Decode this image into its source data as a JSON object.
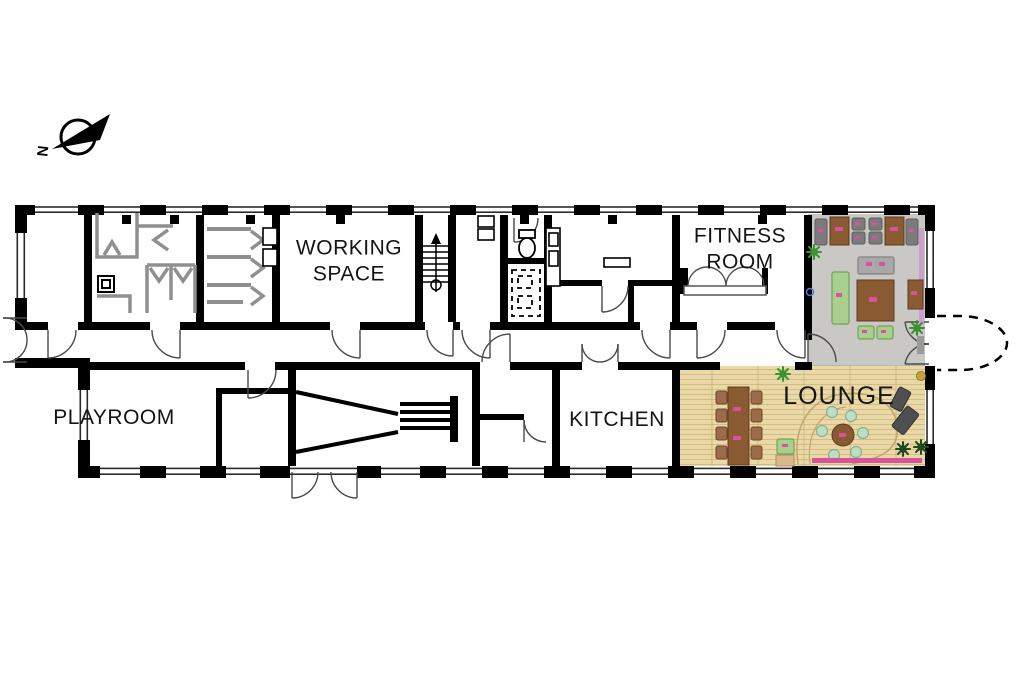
{
  "plan": {
    "rooms": {
      "working_space": {
        "line1": "WORKING",
        "line2": "SPACE"
      },
      "fitness_room": {
        "line1": "FITNESS",
        "line2": "ROOM"
      },
      "playroom": {
        "label": "PLAYROOM"
      },
      "kitchen": {
        "label": "KITCHEN"
      },
      "lounge": {
        "label": "LOUNGE"
      }
    },
    "compass": {
      "north_label": "N"
    }
  },
  "colors": {
    "wall": "#000000",
    "partition": "#8f8f8f",
    "gray_room_floor": "#c9c8c5",
    "lounge_floor": "#ead9a6",
    "plank_line": "#c8b478",
    "wood_table": "#8a5a33",
    "chair_brown": "#9c6b4a",
    "chair_gray": "#7b7b7b",
    "sofa_gray": "#a9a9a9",
    "sofa_green": "#a9cf8e",
    "pouf_teal": "#bfdcc4",
    "recliner_gray": "#4f4f4f",
    "accent_pink": "#d9529c",
    "purple_screen": "#c9a0c9",
    "plant_green": "#3c9232",
    "plant_dark": "#1e4a1e",
    "tan_table": "#d9b98c"
  }
}
